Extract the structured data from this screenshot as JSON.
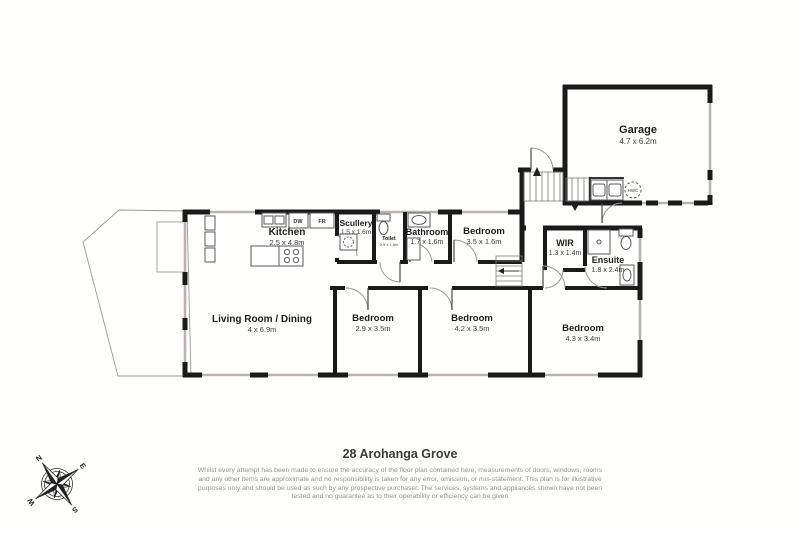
{
  "title": "28 Arohanga Grove",
  "disclaimer": "Whilst every attempt has been made to ensure the accuracy of the floor plan contained here, measurements of doors, windows, rooms and any other items are approximate and no responsibility is taken for any error, omission, or mis-statement. This plan is for illustrative purposes only and should be used as such by any prospective purchaser. The services, systems and appliances shown have not been tested and no guarantee as to their operability or efficiency can be given",
  "compass": {
    "n": "N",
    "e": "E",
    "s": "S",
    "w": "W"
  },
  "appliances": {
    "dw": "DW",
    "fr": "FR",
    "hwc": "HWC"
  },
  "rooms": {
    "garage": {
      "name": "Garage",
      "dims": "4.7 x 6.2m"
    },
    "kitchen": {
      "name": "Kitchen",
      "dims": "2.5 x 4.8m"
    },
    "scullery": {
      "name": "Scullery",
      "dims": "1.5 x 1.6m"
    },
    "toilet": {
      "name": "Toilet",
      "dims": "0.9 x 1.6m"
    },
    "bathroom": {
      "name": "Bathroom",
      "dims": "1.7 x 1.6m"
    },
    "bedroom1": {
      "name": "Bedroom",
      "dims": "3.5 x 1.6m"
    },
    "wir": {
      "name": "WIR",
      "dims": "1.3 x 1.4m"
    },
    "ensuite": {
      "name": "Ensuite",
      "dims": "1.8 x 2.4m"
    },
    "living": {
      "name": "Living Room / Dining",
      "dims": "4 x 6.9m"
    },
    "bedroom2": {
      "name": "Bedroom",
      "dims": "2.9 x 3.5m"
    },
    "bedroom3": {
      "name": "Bedroom",
      "dims": "4.2 x 3.5m"
    },
    "bedroom4": {
      "name": "Bedroom",
      "dims": "4.3 x 3.4m"
    }
  },
  "colors": {
    "wall": "#1a1a1a",
    "window": "#b9b3ab",
    "door": "#999999"
  }
}
